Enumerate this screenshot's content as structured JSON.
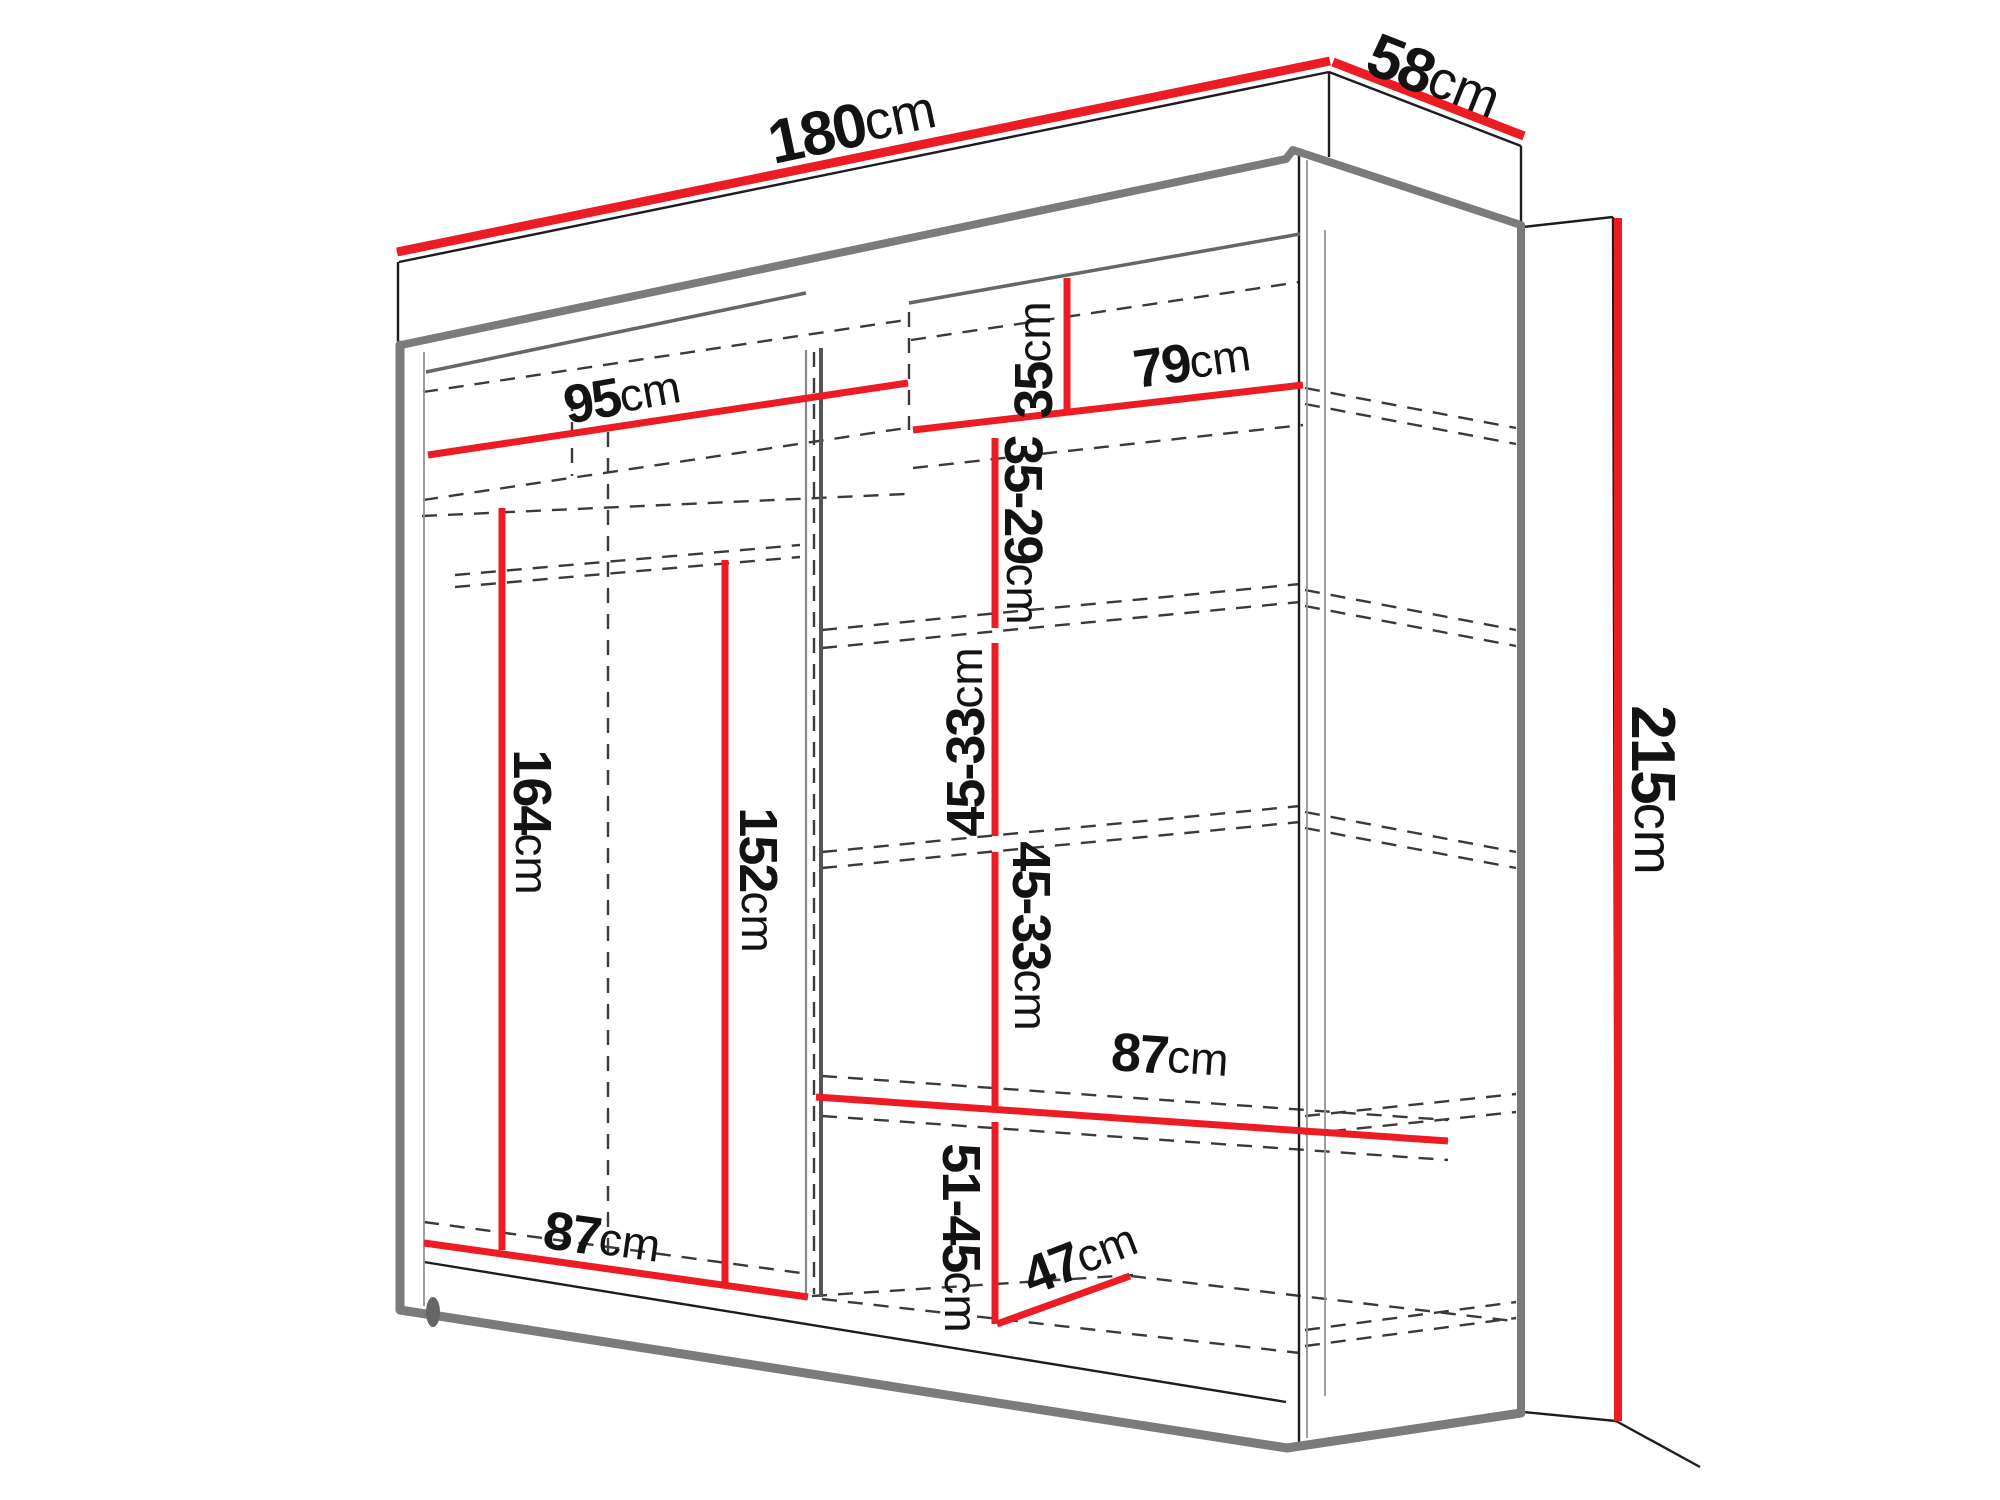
{
  "diagram": {
    "type": "furniture-dimension-diagram",
    "subject": "sliding-door wardrobe with side mirror panel, perspective view with interior shelves shown dashed",
    "colors": {
      "dimension_red": "#ed1c24",
      "outline_gray": "#7b7b7b",
      "edge_black": "#1d1d1d",
      "hidden_line": "#3a3a3a"
    },
    "labels": {
      "width": {
        "value": "180",
        "unit": "cm"
      },
      "depth": {
        "value": "58",
        "unit": "cm"
      },
      "height": {
        "value": "215",
        "unit": "cm"
      },
      "left_section_width": {
        "value": "95",
        "unit": "cm"
      },
      "top_shelf_gap": {
        "value": "35",
        "unit": "cm"
      },
      "right_section_width": {
        "value": "79",
        "unit": "cm"
      },
      "shelf_spacing_1": {
        "value": "35-29",
        "unit": "cm"
      },
      "shelf_spacing_2": {
        "value": "45-33",
        "unit": "cm"
      },
      "shelf_spacing_3": {
        "value": "45-33",
        "unit": "cm"
      },
      "left_interior_height": {
        "value": "164",
        "unit": "cm"
      },
      "left_interior_height_2": {
        "value": "152",
        "unit": "cm"
      },
      "right_shelf_width": {
        "value": "87",
        "unit": "cm"
      },
      "bottom_shelf_spacing": {
        "value": "51-45",
        "unit": "cm"
      },
      "bottom_depth": {
        "value": "47",
        "unit": "cm"
      },
      "left_bottom_width": {
        "value": "87",
        "unit": "cm"
      }
    }
  }
}
